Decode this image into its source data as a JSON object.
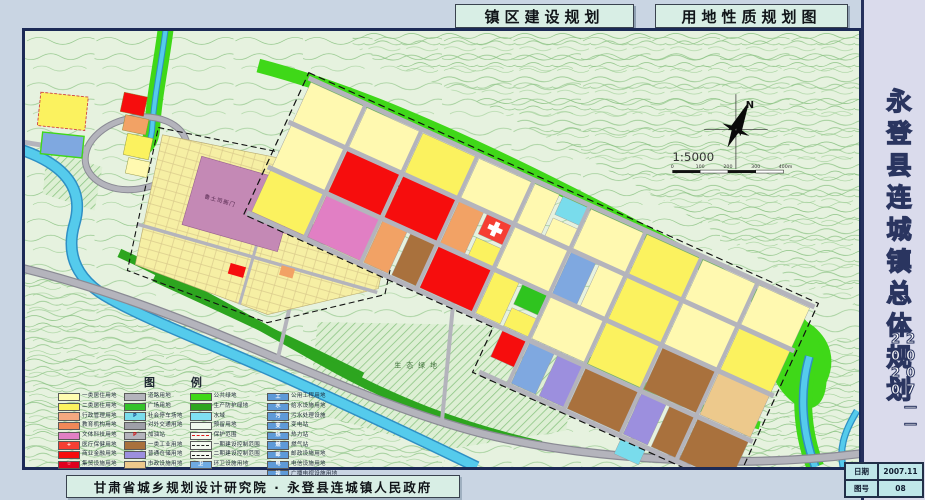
{
  "header": {
    "title_plan": "镇区建设规划",
    "title_sheet": "用地性质规划图"
  },
  "sidebar": {
    "project_title": "永登县连城镇总体规划",
    "period": "2007——2020",
    "info": {
      "date_label": "日期",
      "date_value": "2007.11",
      "sheet_label": "图号",
      "sheet_value": "08"
    }
  },
  "footer": {
    "credit": "甘肃省城乡规划设计研究院 · 永登县连城镇人民政府"
  },
  "map": {
    "north_label": "N",
    "scale_text": "1:5000",
    "scale_ticks": [
      "0",
      "100",
      "200",
      "300",
      "400m"
    ],
    "labels": {
      "eco_green": "生态绿地",
      "heritage": "鲁土司衙门"
    }
  },
  "legend": {
    "title": "图 例",
    "columns": [
      {
        "items": [
          {
            "label": "一类居住用地",
            "color": "#FFFCB0"
          },
          {
            "label": "二类居住用地",
            "color": "#FBF25F"
          },
          {
            "label": "行政管理用地",
            "color": "#F4A880"
          },
          {
            "label": "教育机构用地",
            "color": "#F08858"
          },
          {
            "label": "文体科技用地",
            "color": "#E17FC4"
          },
          {
            "label": "医疗保健用地",
            "color": "#F63E33",
            "glyph": "+",
            "glyph_color": "#ffffff"
          },
          {
            "label": "商业金融用地",
            "color": "#F60D0D"
          },
          {
            "label": "集贸设施用地",
            "color": "#E0001E",
            "glyph": "☆",
            "glyph_color": "#ffffff"
          }
        ]
      },
      {
        "items": [
          {
            "label": "道路用地",
            "color": "#B4B4BC"
          },
          {
            "label": "广场用地",
            "color": "#35C32A"
          },
          {
            "label": "社会停车场地",
            "color": "#79DCEC",
            "glyph": "P",
            "glyph_color": "#14488c"
          },
          {
            "label": "对外交通用地",
            "color": "#9FA0A8"
          },
          {
            "label": "加油站",
            "color": "#B4B4BC",
            "glyph": "P",
            "glyph_color": "#d01010"
          },
          {
            "label": "一类工业用地",
            "color": "#A9713D"
          },
          {
            "label": "普通仓储用地",
            "color": "#9C8FDE"
          },
          {
            "label": "市政设施用地",
            "color": "#EDC98C"
          }
        ]
      },
      {
        "items": [
          {
            "label": "公共绿地",
            "color": "#3FD818"
          },
          {
            "label": "生产防护绿地",
            "color": "#2DA51F"
          },
          {
            "label": "水域",
            "color": "#7FDFF2"
          },
          {
            "label": "预留用地",
            "color": "#F2F8EE"
          },
          {
            "label": "保护范围",
            "line": "dashdot"
          },
          {
            "label": "一期建设控制范围",
            "line": "dash"
          },
          {
            "label": "二期建设控制范围",
            "line": "longdash"
          },
          {
            "label": "环卫设施用地",
            "color": "#6FABE2",
            "glyph": "卫",
            "glyph_color": "#ffffff"
          }
        ]
      },
      {
        "items": [
          {
            "label": "公用工程用地",
            "color": "#5E9AD8",
            "glyph": "工",
            "glyph_color": "#ffffff"
          },
          {
            "label": "给水设施用地",
            "color": "#5E9AD8",
            "glyph": "水",
            "glyph_color": "#ffffff"
          },
          {
            "label": "污水处理设施",
            "color": "#5E9AD8",
            "glyph": "污",
            "glyph_color": "#ffffff"
          },
          {
            "label": "变电站",
            "color": "#5E9AD8",
            "glyph": "变",
            "glyph_color": "#ffffff"
          },
          {
            "label": "热力站",
            "color": "#5E9AD8",
            "glyph": "热",
            "glyph_color": "#ffffff"
          },
          {
            "label": "燃气站",
            "color": "#5E9AD8",
            "glyph": "燃",
            "glyph_color": "#ffffff"
          },
          {
            "label": "邮政设施用地",
            "color": "#5E9AD8",
            "glyph": "邮",
            "glyph_color": "#ffffff"
          },
          {
            "label": "电信设施用地",
            "color": "#5E9AD8",
            "glyph": "电",
            "glyph_color": "#ffffff"
          },
          {
            "label": "广播电视设施用地",
            "color": "#5E9AD8",
            "glyph": "视",
            "glyph_color": "#ffffff"
          }
        ]
      }
    ]
  },
  "colors": {
    "map_background": "#E6F2DF",
    "contour": "#93C78B",
    "water": "#55CBEC",
    "public_green": "#3FD818",
    "protect_green": "#2DA51F",
    "road": "#B4B4BC",
    "frame": "#1C2A56"
  }
}
